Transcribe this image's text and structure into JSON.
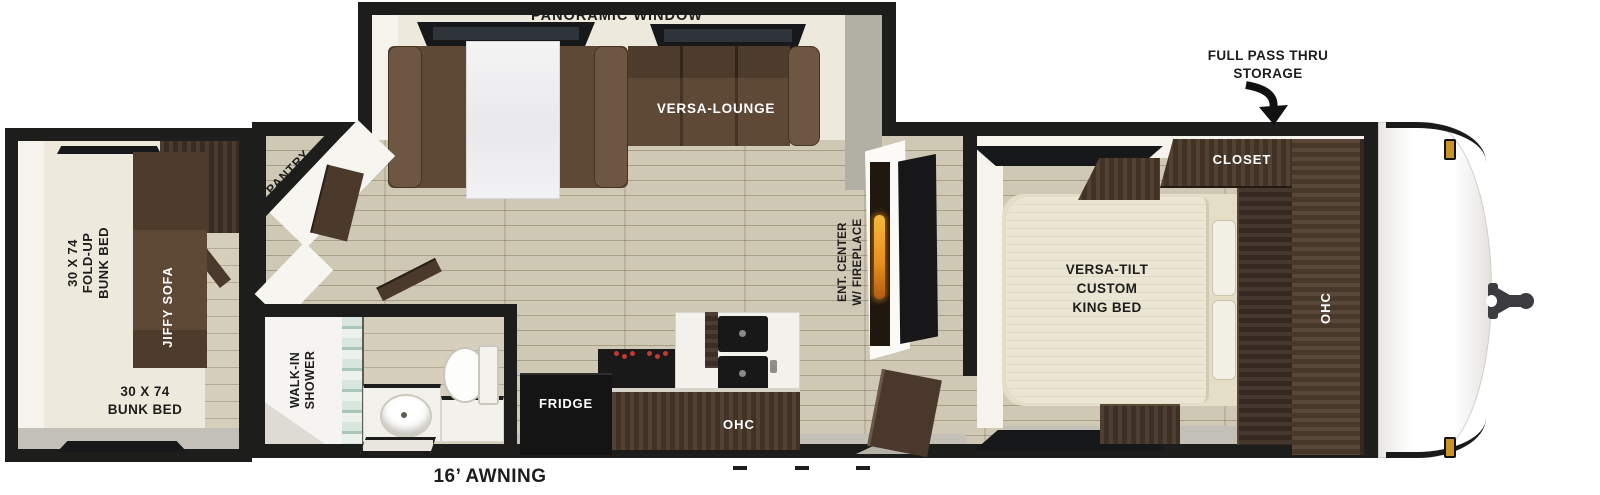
{
  "labels": {
    "panoramic_window": "PANORAMIC WINDOW",
    "full_pass_thru": "FULL PASS THRU\nSTORAGE",
    "versa_lounge": "VERSA-LOUNGE",
    "pantry": "PANTRY",
    "fold_up_bunk": "30 X 74\nFOLD-UP\nBUNK BED",
    "jiffy_sofa": "JIFFY SOFA",
    "bunk_bed": "30 X 74\nBUNK BED",
    "walk_in_shower": "WALK-IN\nSHOWER",
    "fridge": "FRIDGE",
    "kitchen_ohc": "OHC",
    "ent_center": "ENT. CENTER\nW/ FIREPLACE",
    "closet": "CLOSET",
    "king_bed": "VERSA-TILT\nCUSTOM\nKING BED",
    "bedroom_ohc": "OHC",
    "awning": "16’ AWNING"
  },
  "colors": {
    "wall": "#1d1d1b",
    "floor_wood": "#cfc8b5",
    "interior_ivory": "#edeadd",
    "sofa_brown": "#5e4937",
    "cabinet_dark_wood": "#483829",
    "bed_ivory": "#ebe6d3",
    "fireplace_flame": "#e8921f",
    "marker_light_amber": "#c8922a",
    "appliance_black": "#151515"
  }
}
